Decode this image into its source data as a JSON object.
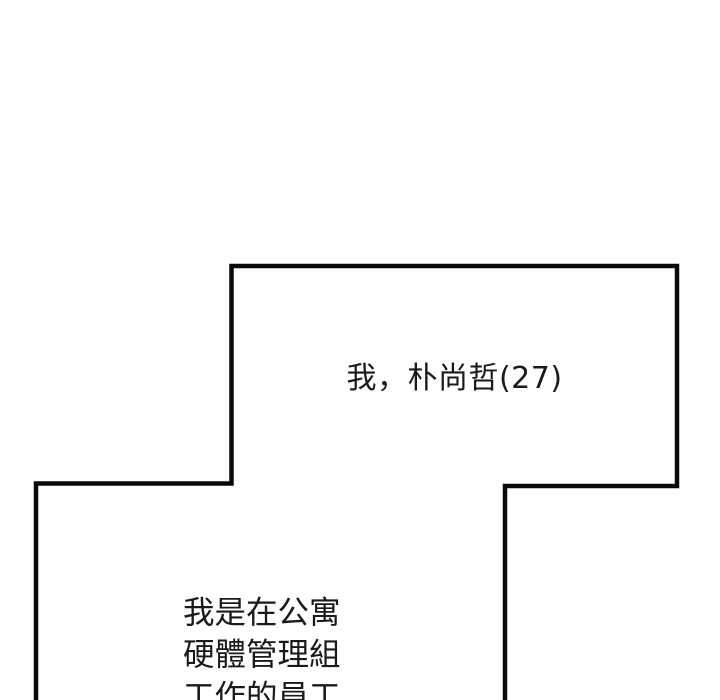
{
  "panel": {
    "top_bubble": {
      "text": "我，朴尚哲(27)"
    },
    "bottom_bubble": {
      "lines": [
        "我是在公寓",
        "硬體管理組",
        "工作的員工"
      ]
    }
  },
  "colors": {
    "background": "#ffffff",
    "panel_fill": "#ffffff",
    "border": "#0a0a0a",
    "text": "#1a1a1a"
  }
}
